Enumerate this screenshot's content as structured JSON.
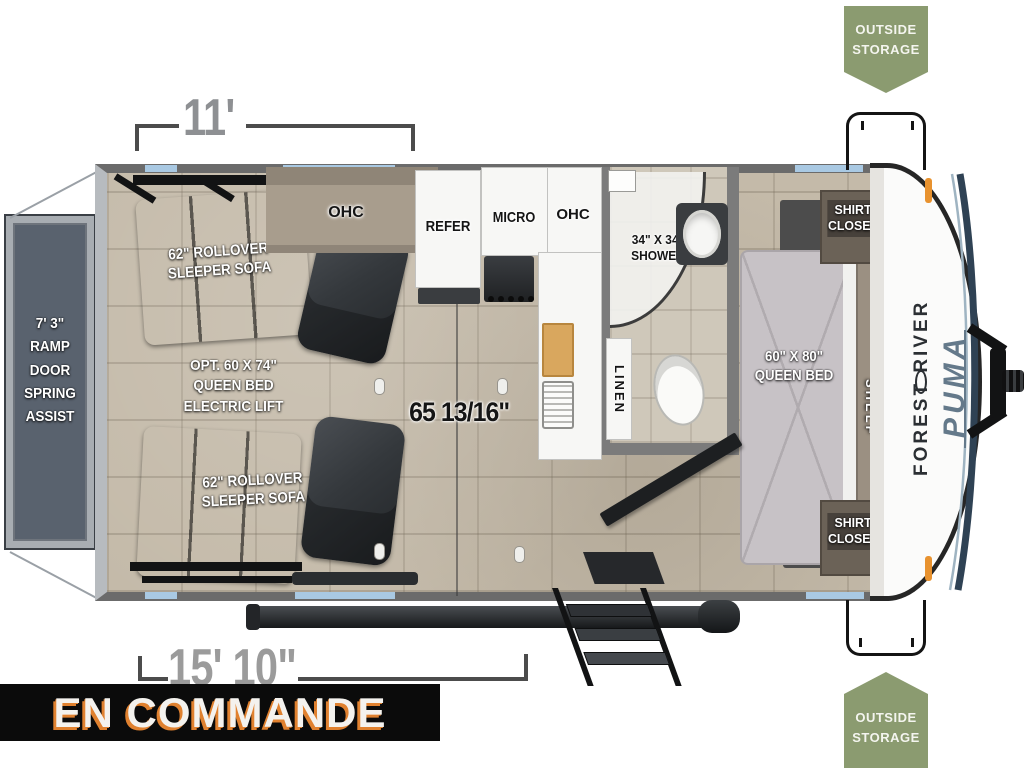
{
  "status_banner": {
    "label": "EN COMMANDE"
  },
  "badges": {
    "top": "OUTSIDE\nSTORAGE",
    "bottom": "OUTSIDE\nSTORAGE"
  },
  "dimensions": {
    "top_width": "11'",
    "bottom_length": "15' 10\"",
    "interior_width": "65 13/16\""
  },
  "labels": {
    "ramp_door": "7' 3\"\nRAMP DOOR\nSPRING\nASSIST",
    "sofa_top": "62\" ROLLOVER\nSLEEPER SOFA",
    "sofa_bottom": "62\" ROLLOVER\nSLEEPER SOFA",
    "opt_queen_bed": "OPT. 60 X 74\"\nQUEEN BED\nELECTRIC LIFT",
    "ohc_living": "OHC",
    "refer": "REFER",
    "micro": "MICRO",
    "ohc_kitchen": "OHC",
    "shower": "34\" X 34\"\nSHOWER",
    "linen": "LINEN",
    "queen_bed": "60\" X 80\"\nQUEEN BED",
    "shirt_closet_top": "SHIRT\nCLOSET",
    "shirt_closet_bottom": "SHIRT\nCLOSET",
    "shelf": "SHELF"
  },
  "branding": {
    "make": "FOREST RIVER",
    "model": "PUMA"
  },
  "colors": {
    "badge_green": "#8b9b70",
    "banner_bg": "#0b0b0b",
    "banner_accent": "#e0812f",
    "window_blue": "#a9c9e3",
    "wall_gray": "#6b6b6b"
  }
}
